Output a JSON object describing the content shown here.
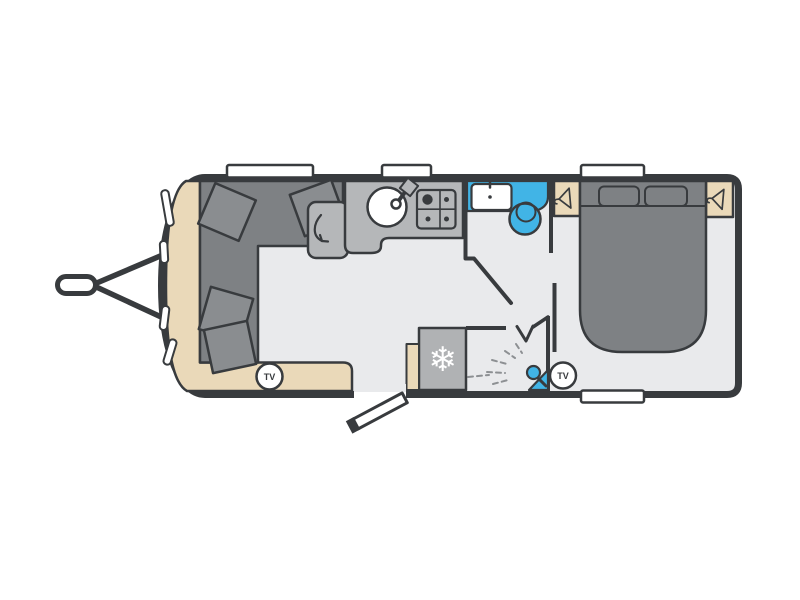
{
  "floorplan": {
    "tv_badges": [
      {
        "label": "TV"
      },
      {
        "label": "TV"
      }
    ],
    "icons": {
      "snowflake_glyph": "❄",
      "fridge": "snowflake-icon",
      "wardrobe": "coat-hanger-icon",
      "shower": "shower-head-icon",
      "sink": "round-sink-with-tap-icon",
      "hob": "four-burner-hob-icon",
      "washbasin": "basin-with-tap-icon",
      "toilet": "toilet-icon",
      "seat_swivel": "curved-arrow-icon",
      "tv": "circled-tv-badge"
    },
    "colors": {
      "page": "#ffffff",
      "wall": "#383b3e",
      "floor": "#e9eaec",
      "trim": "#ead9b9",
      "dark": "#7e8184",
      "cushion": "#8a8d90",
      "worktop": "#b5b7b9",
      "appliance": "#b0b2b4",
      "blue": "#41b4e6",
      "white": "#ffffff",
      "spray": "#8d9093"
    }
  }
}
